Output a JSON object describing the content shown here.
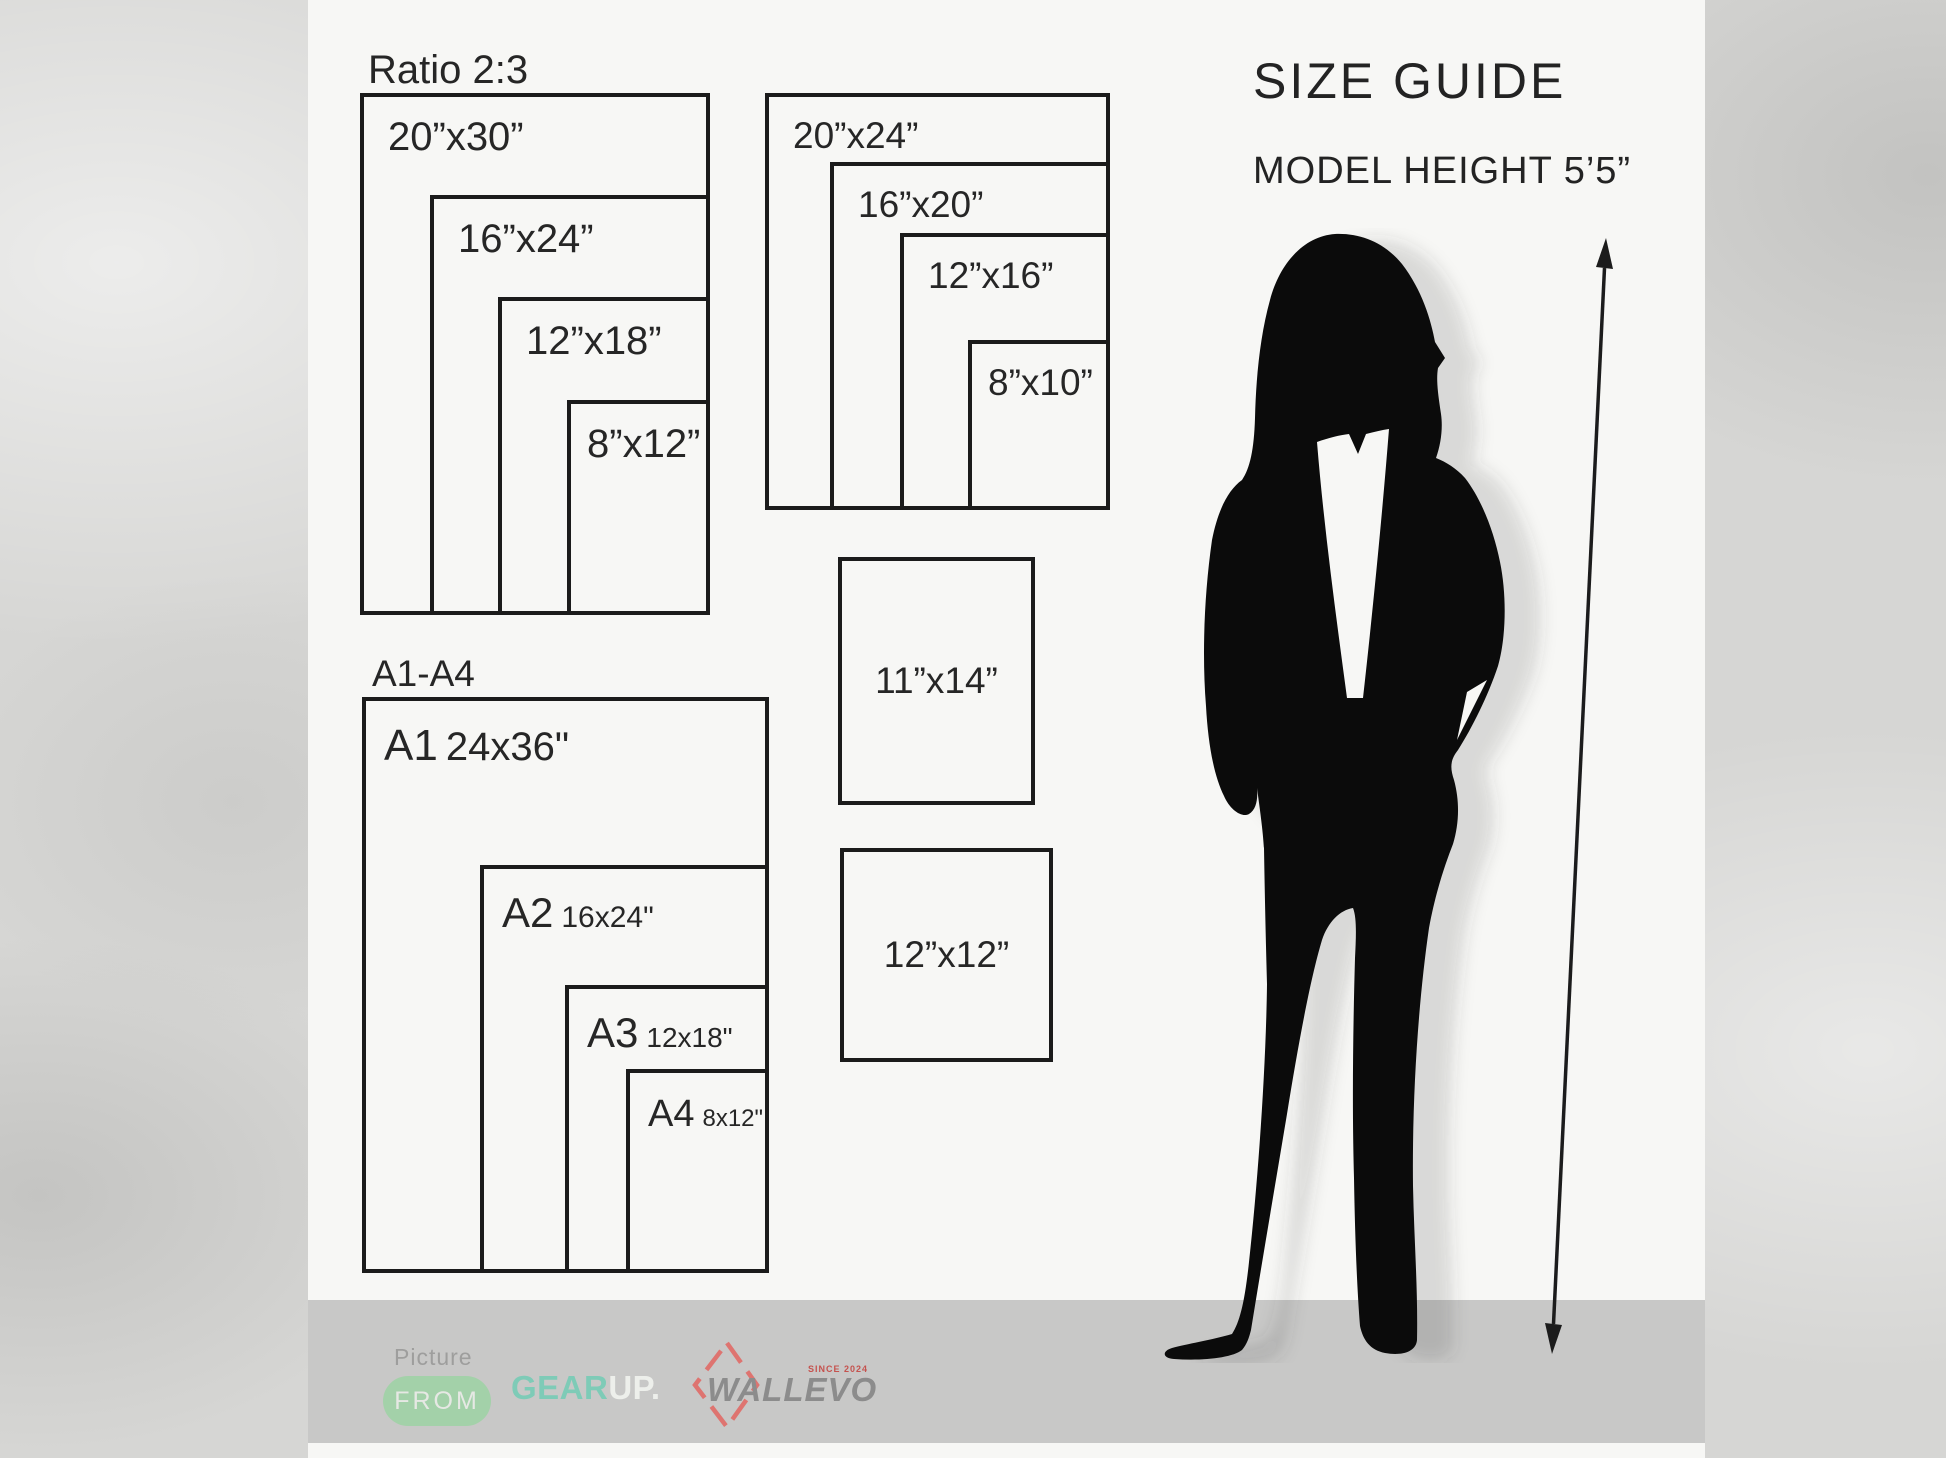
{
  "header": {
    "title": "SIZE GUIDE",
    "model_height": "MODEL HEIGHT 5’5”"
  },
  "ratio_group": {
    "title": "Ratio 2:3",
    "sizes": [
      "20”x30”",
      "16”x24”",
      "12”x18”",
      "8”x12”"
    ]
  },
  "standard_group": {
    "sizes": [
      "20”x24”",
      "16”x20”",
      "12”x16”",
      "8”x10”"
    ]
  },
  "single_boxes": {
    "portrait": "11”x14”",
    "square": "12”x12”"
  },
  "a_series": {
    "title": "A1-A4",
    "items": [
      {
        "code": "A1",
        "size": "24x36\""
      },
      {
        "code": "A2",
        "size": "16x24\""
      },
      {
        "code": "A3",
        "size": "12x18\""
      },
      {
        "code": "A4",
        "size": "8x12\""
      }
    ]
  },
  "footer": {
    "picture": "Picture",
    "from": "FROM",
    "gear": "GEAR",
    "up": "UP.",
    "brand": "WALLEVO",
    "since": "SINCE 2024"
  },
  "colors": {
    "accent_green": "#a3d1a9",
    "mint": "#7ecbb7",
    "salmon": "#de7470",
    "bar_grey": "#c8c8c7",
    "line_black": "#1b1b1b"
  }
}
